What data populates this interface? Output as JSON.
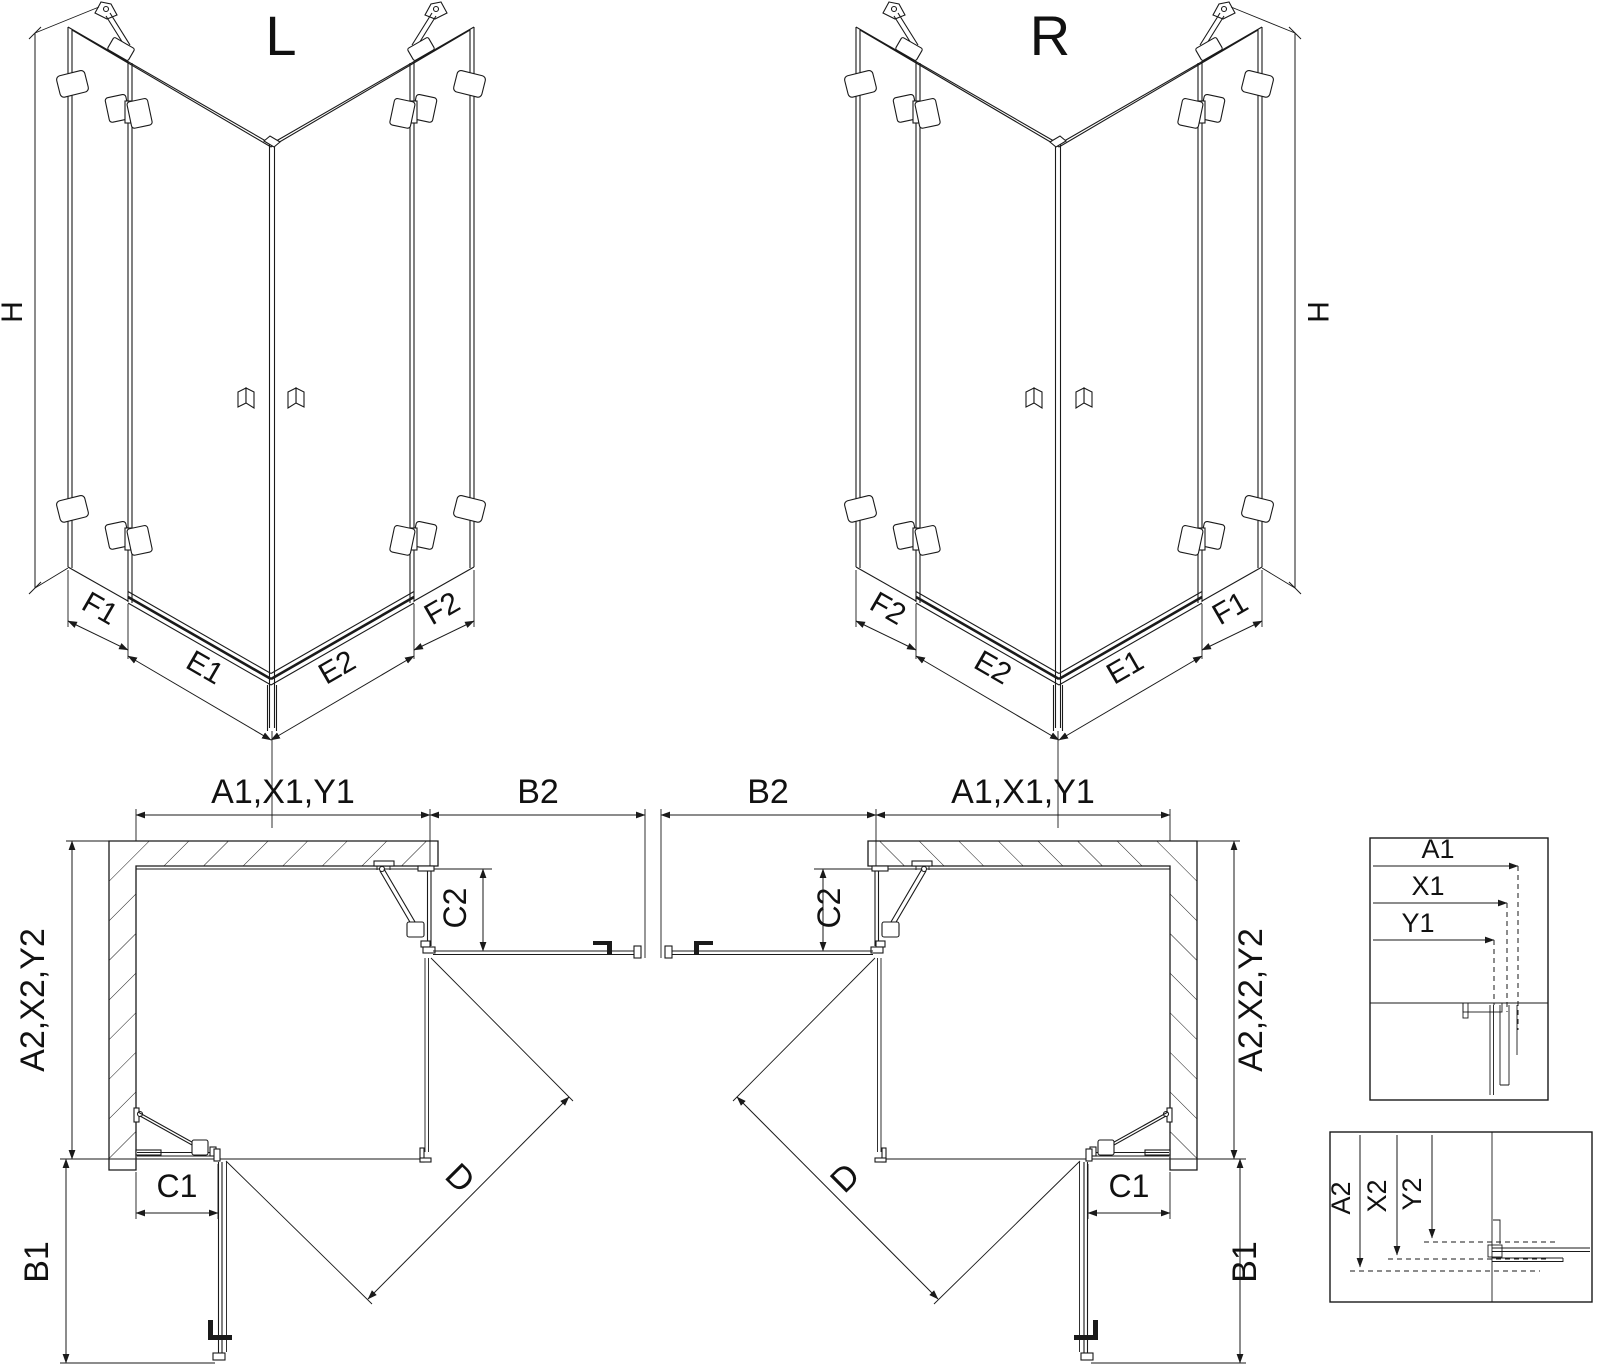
{
  "drawing": {
    "iso_left": {
      "title": "L",
      "dim_height": "H",
      "dim_f1": "F1",
      "dim_e1": "E1",
      "dim_e2": "E2",
      "dim_f2": "F2"
    },
    "iso_right": {
      "title": "R",
      "dim_height": "H",
      "dim_f1": "F1",
      "dim_e1": "E1",
      "dim_e2": "E2",
      "dim_f2": "F2"
    },
    "plan_left": {
      "dim_top": "A1,X1,Y1",
      "dim_top_right": "B2",
      "dim_right_upper": "C2",
      "dim_left": "A2,X2,Y2",
      "dim_bottom_left": "C1",
      "dim_bottom": "B1",
      "dim_diagonal": "D"
    },
    "plan_right": {
      "dim_top": "A1,X1,Y1",
      "dim_top_left": "B2",
      "dim_left_upper": "C2",
      "dim_right": "A2,X2,Y2",
      "dim_bottom_right": "C1",
      "dim_bottom": "B1",
      "dim_diagonal": "D"
    },
    "detail_top": {
      "dim_a1": "A1",
      "dim_x1": "X1",
      "dim_y1": "Y1"
    },
    "detail_bottom": {
      "dim_a2": "A2",
      "dim_x2": "X2",
      "dim_y2": "Y2"
    }
  },
  "colors": {
    "line": "#1a1a1a",
    "background": "#ffffff"
  }
}
